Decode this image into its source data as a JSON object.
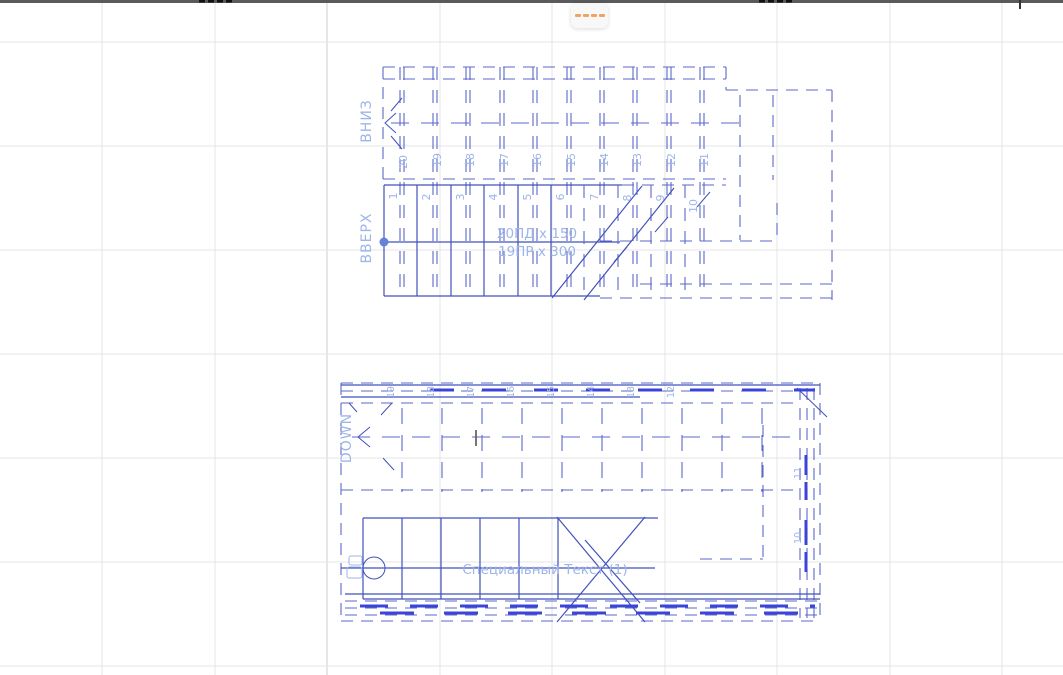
{
  "colors": {
    "canvas-bg": "#ffffff",
    "grid": "#e4e4e4",
    "grid-strong": "#cccccc",
    "top-border": "#5a5a5a",
    "fragment-black": "#111111",
    "line-blue": "#4251bd",
    "line-dash": "#5b68cb",
    "line-bright": "#3a45d8",
    "pale-blue": "#9db5e9",
    "node-blue": "#6482d8",
    "dark-tick": "#555555",
    "orange": "#eda55f",
    "handle-bg": "#f8f8f8"
  },
  "top_stair": {
    "down_label": "ВНИЗ",
    "up_label": "ВВЕРХ",
    "annotation_line1": "20ПД x 150",
    "annotation_line2": "19ПР x 300",
    "lower_riser_numbers": [
      "1",
      "2",
      "3",
      "4",
      "5",
      "6",
      "7",
      "8",
      "9",
      "10"
    ],
    "upper_riser_numbers": [
      "20",
      "19",
      "18",
      "17",
      "16",
      "15",
      "14",
      "13",
      "12",
      "11"
    ]
  },
  "bottom_stair": {
    "down_label": "DOWN",
    "annotation": "Специальный Текст (1)",
    "top_riser_numbers": [
      "19",
      "18",
      "17",
      "16",
      "15",
      "14",
      "13",
      "12"
    ],
    "right_riser_numbers": [
      "11",
      "10"
    ]
  }
}
